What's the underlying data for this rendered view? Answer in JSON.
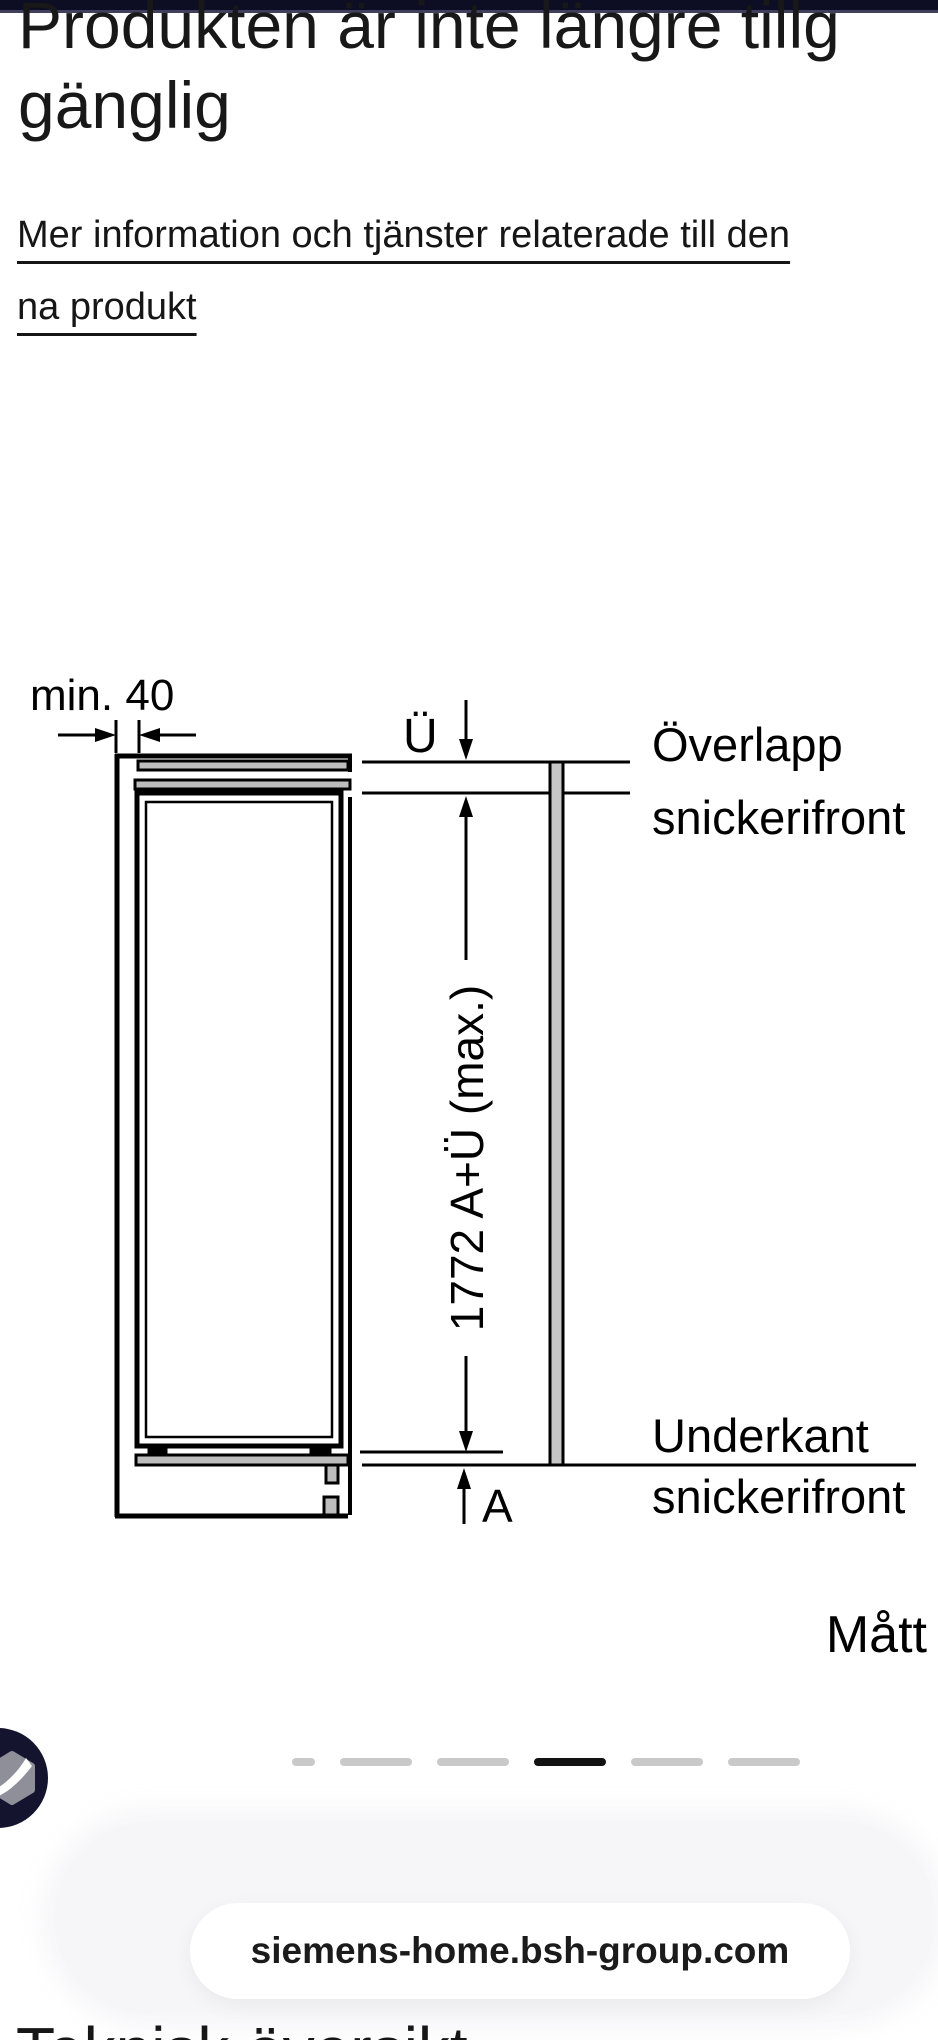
{
  "colors": {
    "top_bar": "#0d0d24",
    "top_bar_edge": "#40405c",
    "text": "#1c1c1c",
    "dot_inactive": "#c9c9c9",
    "dot_active": "#121212",
    "panel_bg": "#f6f6f8",
    "pill_bg": "#ffffff",
    "logo_bg": "#14142e",
    "diagram_gray": "#bdbdbd"
  },
  "heading": {
    "line1": "Produkten är inte längre tillg",
    "line2": "gänglig"
  },
  "product_link": {
    "line1": "Mer information och tjänster relaterade till den",
    "line2": "na produkt"
  },
  "diagram": {
    "min_gap_label": "min. 40",
    "overlap_symbol": "Ü",
    "overlap_label_line1": "Överlapp",
    "overlap_label_line2": "snickerifront",
    "height_dimension": "1772 A+Ü (max.)",
    "bottom_symbol": "A",
    "bottom_label_line1": "Underkant",
    "bottom_label_line2": "snickerifront",
    "caption": "Mått"
  },
  "carousel": {
    "dots": [
      {
        "x": 292,
        "w": 23,
        "active": false
      },
      {
        "x": 340,
        "w": 72,
        "active": false
      },
      {
        "x": 437,
        "w": 72,
        "active": false
      },
      {
        "x": 534,
        "w": 72,
        "active": true
      },
      {
        "x": 631,
        "w": 72,
        "active": false
      },
      {
        "x": 728,
        "w": 72,
        "active": false
      }
    ]
  },
  "link_preview": {
    "url": "siemens-home.bsh-group.com"
  },
  "next_section": {
    "heading": "Teknisk översikt"
  },
  "icons": {
    "brand_badge": "siemens-bsh-badge-icon"
  }
}
